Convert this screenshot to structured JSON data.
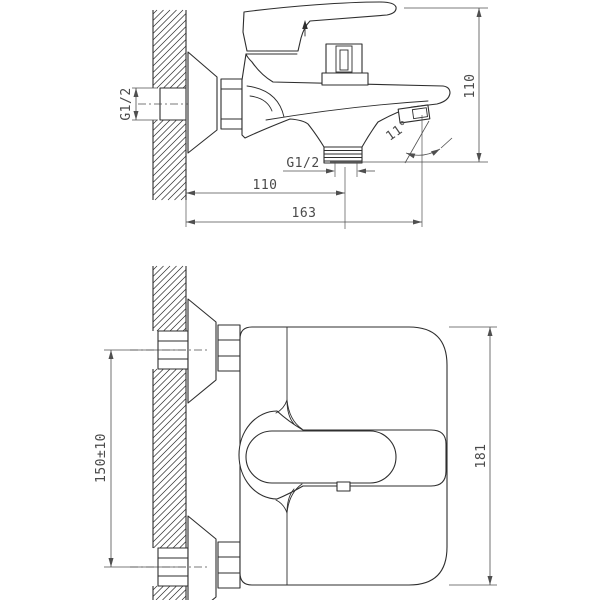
{
  "drawing": {
    "type": "technical-drawing",
    "subject": "wall-mounted bath mixer faucet, two orthographic views",
    "colors": {
      "line": "#2e2e2e",
      "dimension": "#4f4f4f",
      "background": "#ffffff"
    },
    "side_view": {
      "labels": {
        "inlet_thread": "G1/2",
        "overall_height": "110",
        "outlet_thread": "G1/2",
        "wall_to_outlet": "110",
        "wall_to_spout": "163",
        "spout_angle": "11°"
      }
    },
    "front_view": {
      "labels": {
        "inlet_spacing": "150±10",
        "overall_width": "181"
      }
    }
  }
}
